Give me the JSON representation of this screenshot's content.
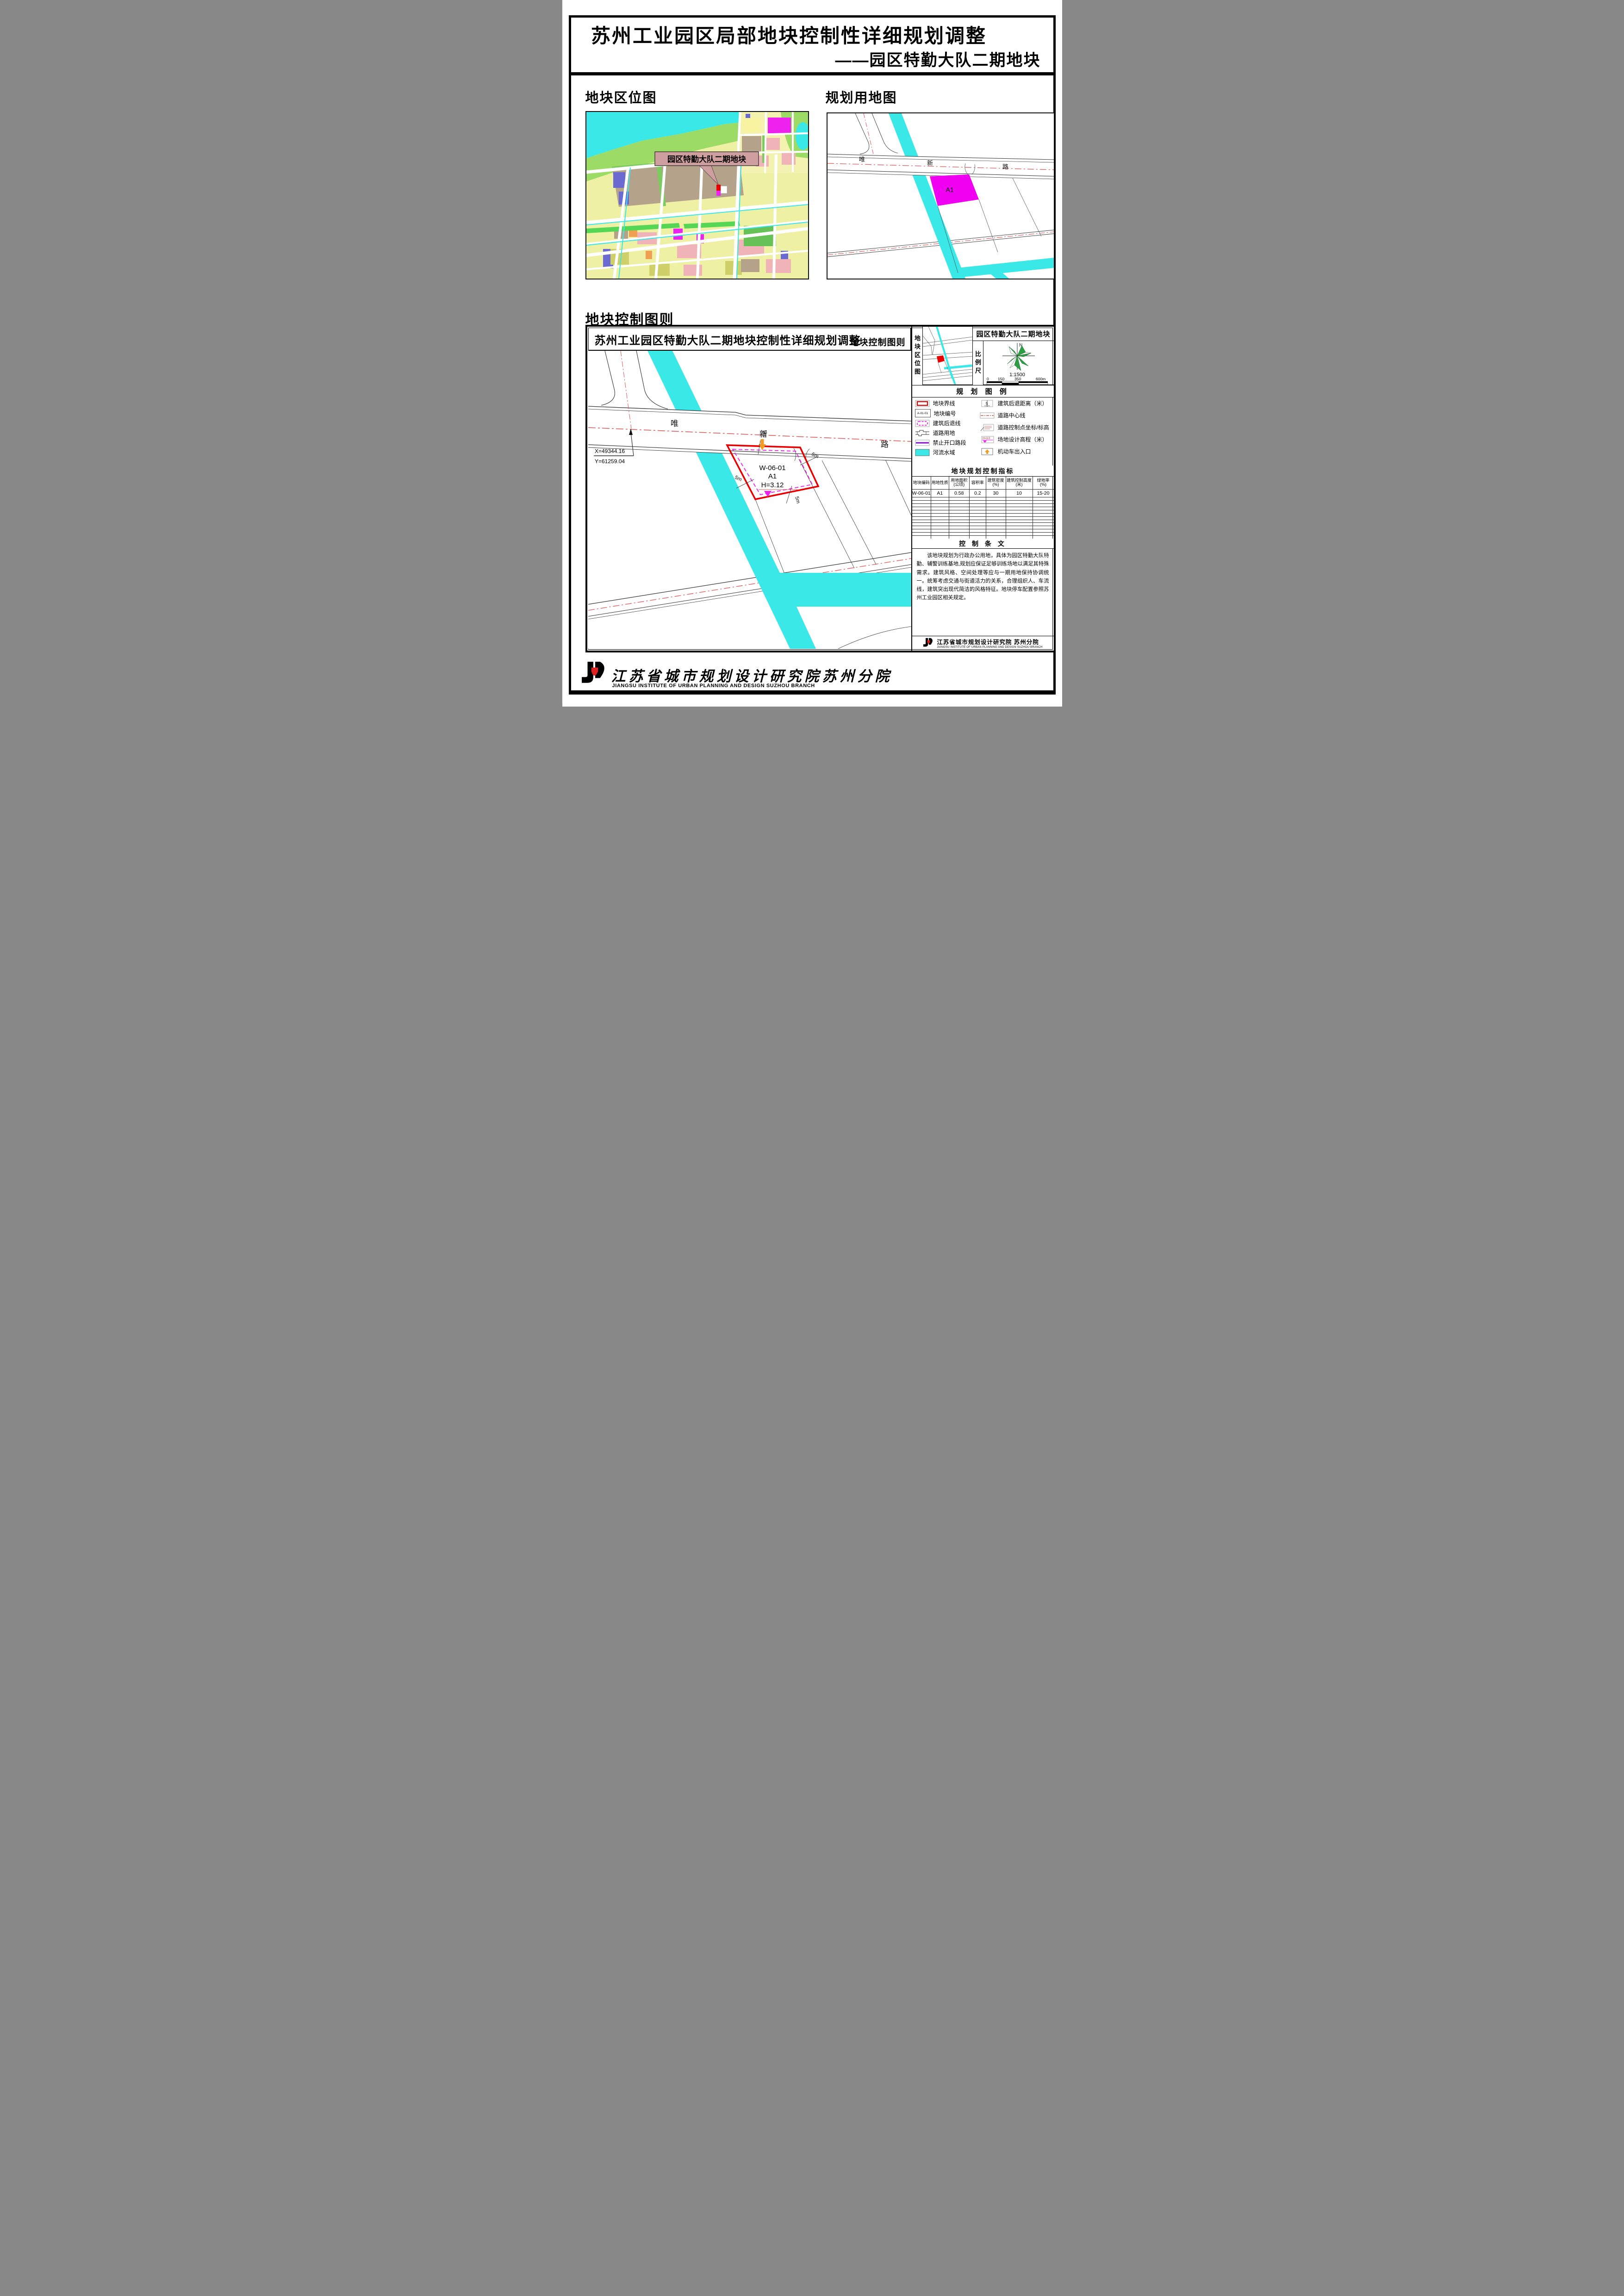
{
  "page": {
    "title_line1": "苏州工业园区局部地块控制性详细规划调整",
    "title_line2": "——园区特勤大队二期地块"
  },
  "sections": {
    "location_map": "地块区位图",
    "landuse_map": "规划用地图",
    "control_chart": "地块控制图则"
  },
  "location_map": {
    "callout": "园区特勤大队二期地块"
  },
  "landuse_map": {
    "road_name": [
      "唯",
      "新",
      "路"
    ],
    "plot_label": "A1"
  },
  "sheet": {
    "header": {
      "title": "苏州工业园区特勤大队二期地块控制性详细规划调整",
      "right_label": "地块控制图则"
    },
    "drawing": {
      "road_name": [
        "唯",
        "新",
        "路"
      ],
      "coord_x": "X=49344.16",
      "coord_y": "Y=61259.04",
      "plot_code": "W-06-01",
      "plot_use": "A1",
      "plot_elevation": "H=3.12",
      "setback": "5m"
    },
    "side": {
      "location_label": "地块区位图",
      "panel_title": "园区特勤大队二期地块",
      "scale_label": "比例尺",
      "north_label": "N",
      "scale_ratio": "1:1500",
      "scale_ticks": [
        "0",
        "150",
        "350",
        "600m"
      ],
      "legend_title": "规 划 图 例",
      "legend_left": [
        {
          "label": "地块界线"
        },
        {
          "label": "地块编号",
          "symbol_text": "A-01-01"
        },
        {
          "label": "建筑后退线"
        },
        {
          "label": "道路用地"
        },
        {
          "label": "禁止开口路段"
        },
        {
          "label": "河流水域"
        }
      ],
      "legend_right": [
        {
          "label": "建筑后退距离（米）",
          "symbol_text": "5"
        },
        {
          "label": "道路中心线"
        },
        {
          "label": "道路控制点坐标/标高"
        },
        {
          "label": "场地设计高程（米）",
          "symbol_text": "H=3.0"
        },
        {
          "label": "机动车出入口"
        }
      ],
      "table": {
        "title": "地块规划控制指标",
        "headers": [
          {
            "l1": "地块编码",
            "l2": ""
          },
          {
            "l1": "用地性质",
            "l2": ""
          },
          {
            "l1": "用地面积",
            "l2": "(公顷)"
          },
          {
            "l1": "容积率",
            "l2": ""
          },
          {
            "l1": "建筑密度",
            "l2": "(%)"
          },
          {
            "l1": "建筑控制高度",
            "l2": "(米)"
          },
          {
            "l1": "绿地率",
            "l2": "(%)"
          }
        ],
        "row": [
          "W-06-01",
          "A1",
          "0.58",
          "0.2",
          "30",
          "10",
          "15-20"
        ]
      },
      "provisions": {
        "title": "控 制 条 文",
        "text": "该地块规划为行政办公用地，具体为园区特勤大队特勤、辅警训练基地,规划应保证足够训练场地以满足其特殊需求。建筑风格、空间处理等应与一期用地保持协调统一。统筹考虑交通与街道活力的关系，合理组织人、车流线，建筑突出现代简洁的风格特征。地块停车配置参照苏州工业园区相关规定。"
      },
      "firm": {
        "cn": "江苏省城市规划设计研究院 苏州分院",
        "en": "JIANGSU INSTITUTE OF URBAN PLANNING AND DESIGN SUZHOU BRANCH"
      }
    }
  },
  "footer": {
    "cn": "江苏省城市规划设计研究院苏州分院",
    "en": "JIANGSU INSTITUTE OF URBAN PLANNING AND DESIGN SUZHOU BRANCH"
  },
  "colors": {
    "water": "#3ae8e8",
    "plot_red": "#e80000",
    "setback_magenta": "#ee22ee",
    "centerline_red": "#e05555",
    "entrance_orange": "#f59a23",
    "compass_green": "#2e9e44",
    "callout_bg": "#cf9f9f"
  }
}
